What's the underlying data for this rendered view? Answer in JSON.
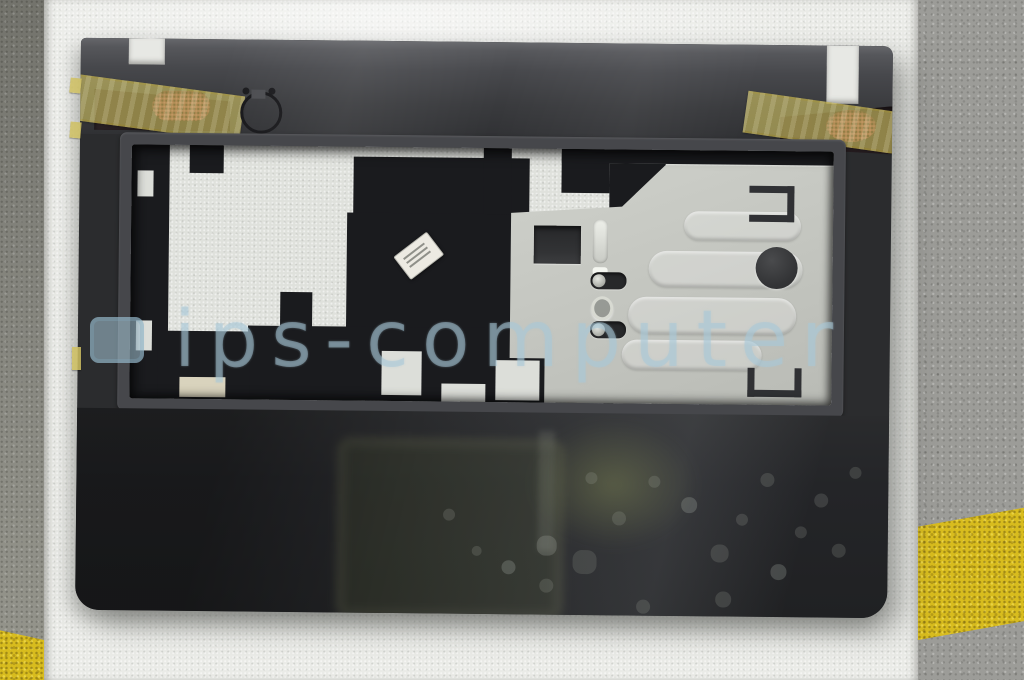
{
  "scene": {
    "type": "product-photograph",
    "subject": "Dark laptop palmrest upper-case assembly lying on white foam packaging over a concrete floor with yellow painted stripes",
    "watermark": {
      "text": "ips-computer",
      "logo": "rounded-square-logo"
    },
    "objects": {
      "part": "laptop palmrest with keyboard aperture, two taped speaker grilles, power-button ring cutout and silver touchpad support plate",
      "label_sticker": "small white sticker with illegible print",
      "packaging": "white polystyrene foam sheet",
      "floor": "gray speckled concrete with yellow safety stripe"
    },
    "colors": {
      "part_dark": "#2b2c2e",
      "part_top_gray": "#56575b",
      "understructure_black": "#1a1b1e",
      "plate_silver": "#c5c7c1",
      "foam_white": "#eaebe7",
      "concrete_gray": "#9c9c98",
      "concrete_dark": "#82827b",
      "yellow_paint": "#d8bc1e",
      "tape_yellow": "#d5c664",
      "speaker_mesh_red": "#7d3542",
      "watermark_blue": "#a8c8d8",
      "sticker_white": "#eceae2"
    }
  }
}
